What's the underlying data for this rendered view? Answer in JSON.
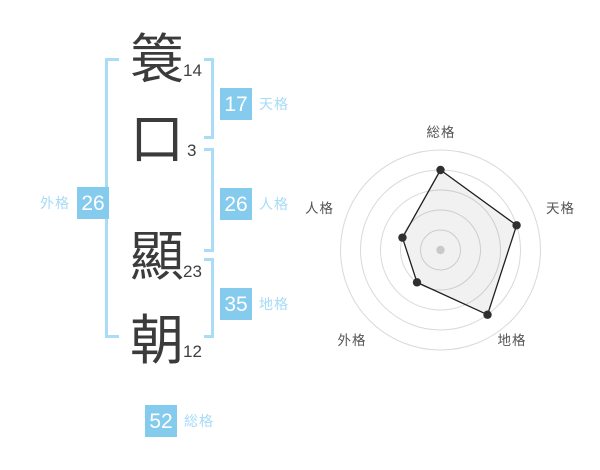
{
  "name": {
    "surname": [
      {
        "char": "簑",
        "strokes": "14"
      },
      {
        "char": "口",
        "strokes": "3"
      }
    ],
    "given": [
      {
        "char": "顯",
        "strokes": "23"
      },
      {
        "char": "朝",
        "strokes": "12"
      }
    ]
  },
  "scores": {
    "tenkaku": {
      "label": "天格",
      "value": "17"
    },
    "jinkaku": {
      "label": "人格",
      "value": "26"
    },
    "chikaku": {
      "label": "地格",
      "value": "35"
    },
    "gaikaku": {
      "label": "外格",
      "value": "26"
    },
    "soukaku": {
      "label": "総格",
      "value": "52"
    }
  },
  "colors": {
    "badge_blue": "#85cbee",
    "bracket_blue": "#aadcf6",
    "label_blue": "#a5dbf7",
    "text_dark": "#3b3b3b",
    "radar_grid": "#d9d9d9",
    "radar_line": "#1f1f1f",
    "radar_dot": "#2f2f2f",
    "radar_fill": "rgba(0,0,0,0.055)",
    "radar_label": "#555555",
    "radar_center_dot": "#c9c9c9"
  },
  "chart_data": {
    "type": "radar",
    "categories": [
      "総格",
      "天格",
      "地格",
      "外格",
      "人格"
    ],
    "values": [
      80,
      80,
      80,
      40,
      40
    ],
    "max": 100,
    "rings": 5,
    "start_angle_deg": -90,
    "direction": "clockwise",
    "grid": "circular",
    "legend_position": "none",
    "title": ""
  }
}
